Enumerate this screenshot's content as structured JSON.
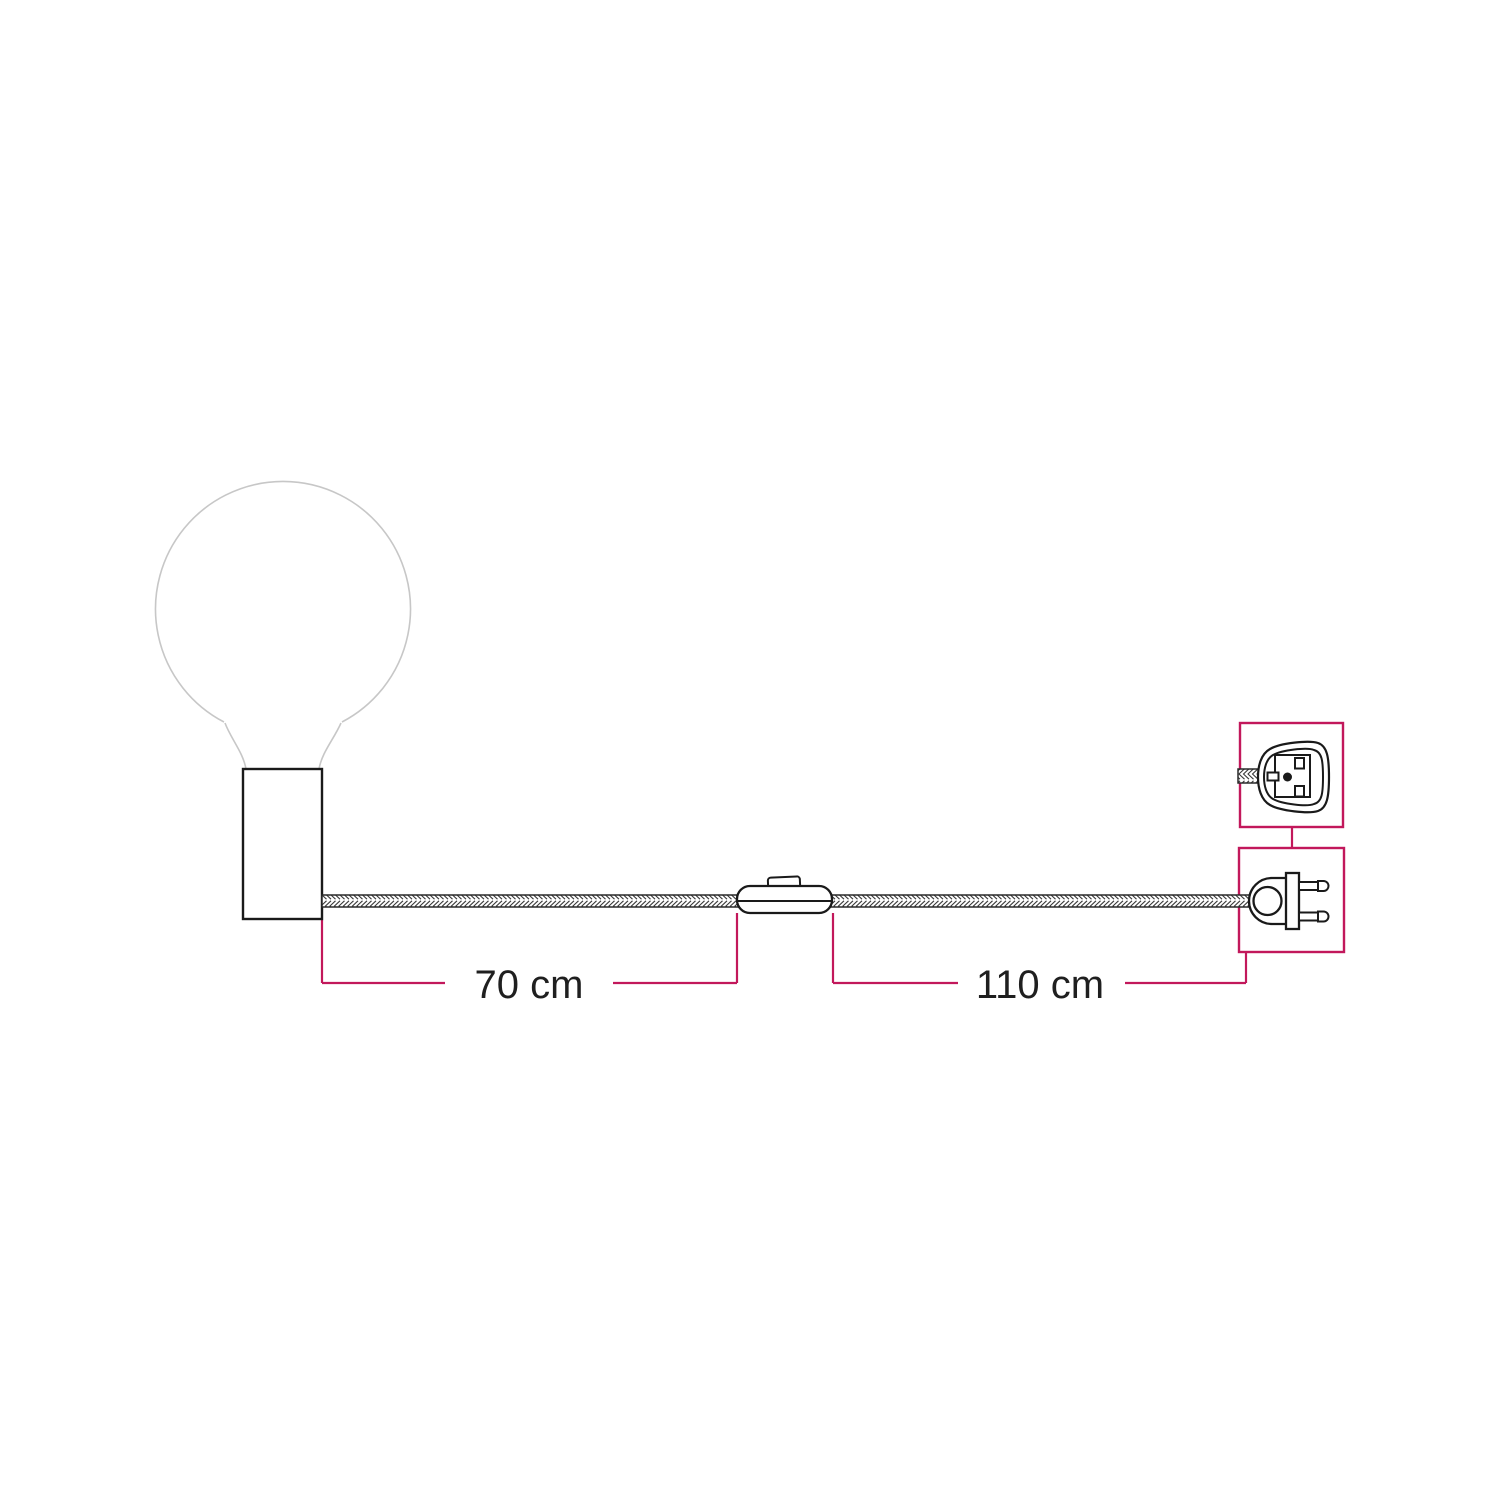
{
  "page": {
    "background": "#ffffff",
    "width": 1500,
    "height": 1500
  },
  "colors": {
    "accent_pink": "#c2185b",
    "line_dark": "#1a1a1a",
    "line_light_gray": "#c7c7c7",
    "cable_stroke": "#3a3a3a",
    "text": "#1f1f1f"
  },
  "diagram": {
    "components": [
      {
        "icon": "globe-bulb-icon"
      },
      {
        "icon": "lamp-holder-icon"
      },
      {
        "icon": "braided-cable-icon"
      },
      {
        "icon": "inline-switch-icon"
      },
      {
        "icon": "two-pin-plug-front-icon"
      },
      {
        "icon": "two-pin-plug-side-icon"
      }
    ],
    "dimensions": [
      {
        "label": "70 cm",
        "value_cm": 70,
        "from": "lamp-holder",
        "to": "inline-switch"
      },
      {
        "label": "110 cm",
        "value_cm": 110,
        "from": "inline-switch",
        "to": "plug"
      }
    ],
    "insets": [
      {
        "name": "plug-front-view"
      },
      {
        "name": "plug-side-view"
      }
    ]
  }
}
